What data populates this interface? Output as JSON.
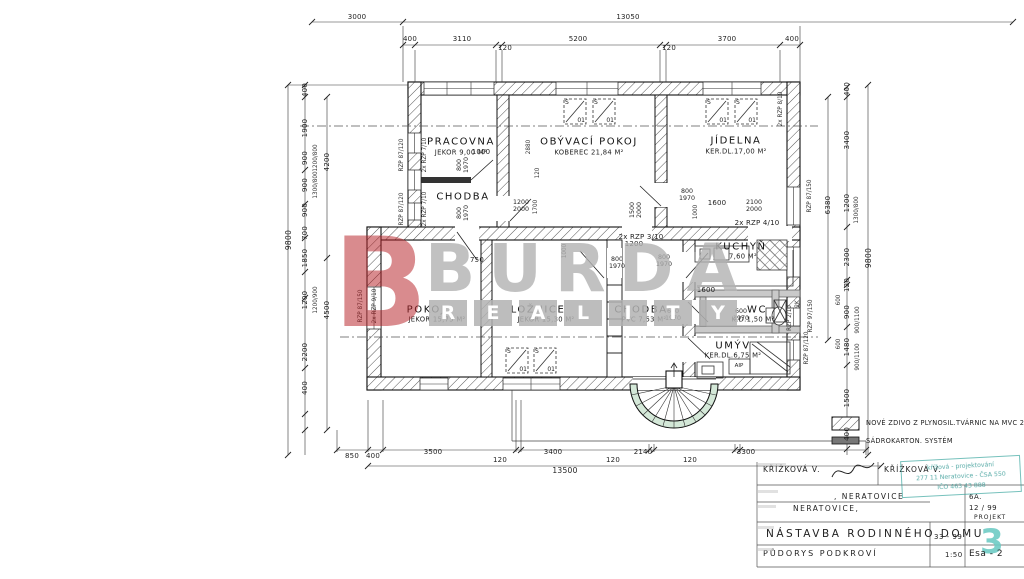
{
  "window_symbol": {
    "top": "S",
    "bottom": "01"
  },
  "watermark": {
    "b": "B",
    "brand": "BURDA",
    "sub": "REALITY"
  },
  "legend": {
    "items": [
      {
        "label": "NOVÉ ZDIVO Z PLYNOSIL.TVÁRNIC NA MVC 25-"
      },
      {
        "label": "SÁDROKARTON. SYSTÉM"
      }
    ]
  },
  "titleblock": {
    "author": "KŘÍŽKOVÁ V.",
    "author2": "KŘÍŽKOVÁ V.",
    "place1": ", NERATOVICE",
    "place2": "NERATOVICE,",
    "code": "6A.",
    "date": "12 / 99",
    "project_label": "PROJEKT",
    "project_number": "3",
    "project_title": "NÁSTAVBA RODINNÉHO DOMU",
    "project_code": "33 - 99",
    "drawing_title": "PŮDORYS PODKROVÍ",
    "scale": "1:50",
    "sheet": "Esa - 2"
  },
  "stamp": {
    "line1": "křížová - projektování",
    "line2": "277 11 Neratovice - ČSA 550",
    "line3": "IČO 463 43 888"
  },
  "colors": {
    "line": "#1a1a1a",
    "watermark_red": "#b72026",
    "watermark_gray": "#b2b2b2",
    "stamp_teal": "#2da098",
    "stair_green": "#d4e8d8"
  },
  "plan": {
    "window_positions": [
      {
        "x": 563,
        "y": 98
      },
      {
        "x": 592,
        "y": 98
      },
      {
        "x": 705,
        "y": 98
      },
      {
        "x": 734,
        "y": 98
      },
      {
        "x": 505,
        "y": 347
      },
      {
        "x": 533,
        "y": 347
      }
    ],
    "labels": [
      {
        "t": "3000",
        "x": 357,
        "y": 18
      },
      {
        "t": "13050",
        "x": 628,
        "y": 18
      },
      {
        "t": "400",
        "x": 410,
        "y": 40
      },
      {
        "t": "3110",
        "x": 462,
        "y": 40
      },
      {
        "t": "120",
        "x": 505,
        "y": 49
      },
      {
        "t": "5200",
        "x": 578,
        "y": 40
      },
      {
        "t": "120",
        "x": 669,
        "y": 49
      },
      {
        "t": "3700",
        "x": 727,
        "y": 40
      },
      {
        "t": "400",
        "x": 792,
        "y": 40
      },
      {
        "t": "9800",
        "x": 289,
        "y": 240,
        "c": "t",
        "r": 1
      },
      {
        "t": "400",
        "x": 306,
        "y": 90,
        "r": 1
      },
      {
        "t": "1900",
        "x": 306,
        "y": 128,
        "r": 1
      },
      {
        "t": "900",
        "x": 306,
        "y": 158,
        "r": 1
      },
      {
        "t": "900",
        "x": 306,
        "y": 185,
        "r": 1
      },
      {
        "t": "900",
        "x": 306,
        "y": 210,
        "r": 1
      },
      {
        "t": "700",
        "x": 306,
        "y": 233,
        "r": 1
      },
      {
        "t": "1850",
        "x": 306,
        "y": 258,
        "r": 1
      },
      {
        "t": "1200",
        "x": 306,
        "y": 300,
        "r": 1
      },
      {
        "t": "2200",
        "x": 306,
        "y": 352,
        "r": 1
      },
      {
        "t": "400",
        "x": 306,
        "y": 388,
        "r": 1
      },
      {
        "t": "4200",
        "x": 328,
        "y": 162,
        "r": 1
      },
      {
        "t": "4500",
        "x": 328,
        "y": 310,
        "r": 1
      },
      {
        "t": "1200/800",
        "x": 316,
        "y": 158,
        "c": "w",
        "r": 1
      },
      {
        "t": "1300/800",
        "x": 316,
        "y": 185,
        "c": "w",
        "r": 1
      },
      {
        "t": "1200/900",
        "x": 316,
        "y": 300,
        "c": "w",
        "r": 1
      },
      {
        "t": "9800",
        "x": 869,
        "y": 258,
        "c": "t",
        "r": 1
      },
      {
        "t": "6380",
        "x": 829,
        "y": 205,
        "r": 1
      },
      {
        "t": "400",
        "x": 848,
        "y": 89,
        "r": 1
      },
      {
        "t": "3400",
        "x": 848,
        "y": 140,
        "r": 1
      },
      {
        "t": "1200",
        "x": 848,
        "y": 203,
        "r": 1
      },
      {
        "t": "1300/800",
        "x": 857,
        "y": 210,
        "c": "w",
        "r": 1
      },
      {
        "t": "2300",
        "x": 848,
        "y": 257,
        "r": 1
      },
      {
        "t": "120",
        "x": 848,
        "y": 285,
        "r": 1
      },
      {
        "t": "900",
        "x": 848,
        "y": 312,
        "r": 1
      },
      {
        "t": "1480",
        "x": 848,
        "y": 347,
        "r": 1
      },
      {
        "t": "1500",
        "x": 848,
        "y": 398,
        "r": 1
      },
      {
        "t": "400",
        "x": 848,
        "y": 434,
        "r": 1
      },
      {
        "t": "600",
        "x": 839,
        "y": 300,
        "c": "w",
        "r": 1
      },
      {
        "t": "900/1100",
        "x": 858,
        "y": 320,
        "c": "w",
        "r": 1
      },
      {
        "t": "600",
        "x": 839,
        "y": 344,
        "c": "w",
        "r": 1
      },
      {
        "t": "900/1100",
        "x": 858,
        "y": 357,
        "c": "w",
        "r": 1
      },
      {
        "t": "RZP 87/120",
        "x": 402,
        "y": 155,
        "c": "w",
        "r": 1
      },
      {
        "t": "2x RZP 7/10",
        "x": 425,
        "y": 155,
        "c": "w",
        "r": 1
      },
      {
        "t": "RZP 87/120",
        "x": 402,
        "y": 209,
        "c": "w",
        "r": 1
      },
      {
        "t": "2x RZP 7/10",
        "x": 425,
        "y": 209,
        "c": "w",
        "r": 1
      },
      {
        "t": "RZP 87/150",
        "x": 361,
        "y": 306,
        "c": "w",
        "r": 1
      },
      {
        "t": "2x RZP 9/10",
        "x": 375,
        "y": 306,
        "c": "w",
        "r": 1
      },
      {
        "t": "RZP 87/150",
        "x": 810,
        "y": 196,
        "c": "w",
        "r": 1
      },
      {
        "t": "2x RZP 8/10",
        "x": 781,
        "y": 109,
        "c": "w",
        "r": 1
      },
      {
        "t": "RZP 97/150",
        "x": 811,
        "y": 316,
        "c": "w",
        "r": 1
      },
      {
        "t": "RZP 87/120",
        "x": 807,
        "y": 348,
        "c": "w",
        "r": 1
      },
      {
        "t": "RZP 2/10",
        "x": 790,
        "y": 318,
        "c": "w",
        "r": 1
      },
      {
        "t": "2K",
        "x": 798,
        "y": 304,
        "c": "w",
        "r": 1
      },
      {
        "t": "PRACOVNA",
        "x": 461,
        "y": 143,
        "c": "room",
        "n": "room-pracovna"
      },
      {
        "t": "JEKOR 9,00 M²",
        "x": 461,
        "y": 153,
        "c": "s"
      },
      {
        "t": "CHODBA",
        "x": 463,
        "y": 198,
        "c": "room",
        "n": "room-chodba-upper"
      },
      {
        "t": "OBÝVACÍ POKOJ",
        "x": 589,
        "y": 143,
        "c": "room",
        "n": "room-obyvaci-pokoj"
      },
      {
        "t": "KOBEREC 21,84 M²",
        "x": 589,
        "y": 153,
        "c": "s"
      },
      {
        "t": "JÍDELNA",
        "x": 736,
        "y": 142,
        "c": "room",
        "n": "room-jidelna"
      },
      {
        "t": "KER.DL.17,00 M²",
        "x": 736,
        "y": 152,
        "c": "s"
      },
      {
        "t": "KUCHYŇ",
        "x": 741,
        "y": 248,
        "c": "room",
        "n": "room-kuchyn"
      },
      {
        "t": "7,60 M²",
        "x": 743,
        "y": 257,
        "c": "s"
      },
      {
        "t": "POKOJ",
        "x": 426,
        "y": 311,
        "c": "room",
        "n": "room-pokoj"
      },
      {
        "t": "JEKOR 15,75 M²",
        "x": 437,
        "y": 320,
        "c": "s"
      },
      {
        "t": "LOŽNICE",
        "x": 538,
        "y": 311,
        "c": "room",
        "n": "room-loznice"
      },
      {
        "t": "JEKOR 15,30 M²",
        "x": 546,
        "y": 320,
        "c": "s"
      },
      {
        "t": "CHODBA",
        "x": 641,
        "y": 311,
        "c": "room",
        "n": "room-chodba-lower"
      },
      {
        "t": "PVC 7,53 M²",
        "x": 644,
        "y": 320,
        "c": "s"
      },
      {
        "t": "WC",
        "x": 757,
        "y": 311,
        "c": "room",
        "n": "room-wc"
      },
      {
        "t": "K.D.1,50 M²",
        "x": 753,
        "y": 320,
        "c": "s"
      },
      {
        "t": "UMÝV",
        "x": 733,
        "y": 347,
        "c": "room",
        "n": "room-umyv"
      },
      {
        "t": "KER.DL.6,75 M²",
        "x": 733,
        "y": 356,
        "c": "s"
      },
      {
        "t": "AIP",
        "x": 739,
        "y": 367,
        "c": "s6"
      },
      {
        "t": "1000",
        "x": 481,
        "y": 153
      },
      {
        "t": "800\n1970",
        "x": 464,
        "y": 165,
        "c": "d2",
        "r": 1
      },
      {
        "t": "800\n1970",
        "x": 464,
        "y": 213,
        "c": "d2",
        "r": 1
      },
      {
        "t": "1200\n2000",
        "x": 521,
        "y": 207,
        "c": "d2"
      },
      {
        "t": "1700",
        "x": 536,
        "y": 207,
        "c": "w",
        "r": 1
      },
      {
        "t": "2880",
        "x": 529,
        "y": 147,
        "c": "w",
        "r": 1
      },
      {
        "t": "120",
        "x": 538,
        "y": 173,
        "c": "w",
        "r": 1
      },
      {
        "t": "800\n1970",
        "x": 687,
        "y": 196,
        "c": "d2"
      },
      {
        "t": "1500\n2000",
        "x": 637,
        "y": 210,
        "c": "d2",
        "r": 1
      },
      {
        "t": "1000",
        "x": 696,
        "y": 212,
        "c": "w",
        "r": 1
      },
      {
        "t": "1600",
        "x": 717,
        "y": 204
      },
      {
        "t": "2100\n2000",
        "x": 754,
        "y": 207,
        "c": "d2"
      },
      {
        "t": "2x RZP 4/10",
        "x": 757,
        "y": 224
      },
      {
        "t": "2x RZP 3/10",
        "x": 641,
        "y": 238
      },
      {
        "t": "1200",
        "x": 634,
        "y": 245
      },
      {
        "t": "750",
        "x": 477,
        "y": 261
      },
      {
        "t": "1000",
        "x": 565,
        "y": 251,
        "c": "w",
        "r": 1
      },
      {
        "t": "800\n1970",
        "x": 617,
        "y": 264,
        "c": "d2"
      },
      {
        "t": "800\n1970",
        "x": 664,
        "y": 262,
        "c": "d2"
      },
      {
        "t": "1600",
        "x": 706,
        "y": 291
      },
      {
        "t": "600\n1970",
        "x": 673,
        "y": 316,
        "c": "d2"
      },
      {
        "t": "600\n1970",
        "x": 741,
        "y": 316,
        "c": "d2"
      },
      {
        "t": "850",
        "x": 352,
        "y": 457
      },
      {
        "t": "400",
        "x": 373,
        "y": 457
      },
      {
        "t": "3500",
        "x": 433,
        "y": 453
      },
      {
        "t": "120",
        "x": 500,
        "y": 461
      },
      {
        "t": "3400",
        "x": 553,
        "y": 453
      },
      {
        "t": "120",
        "x": 613,
        "y": 461
      },
      {
        "t": "2140",
        "x": 643,
        "y": 453
      },
      {
        "t": "120",
        "x": 690,
        "y": 461
      },
      {
        "t": "3300",
        "x": 746,
        "y": 453
      },
      {
        "t": "13500",
        "x": 565,
        "y": 471,
        "c": "t"
      }
    ]
  }
}
